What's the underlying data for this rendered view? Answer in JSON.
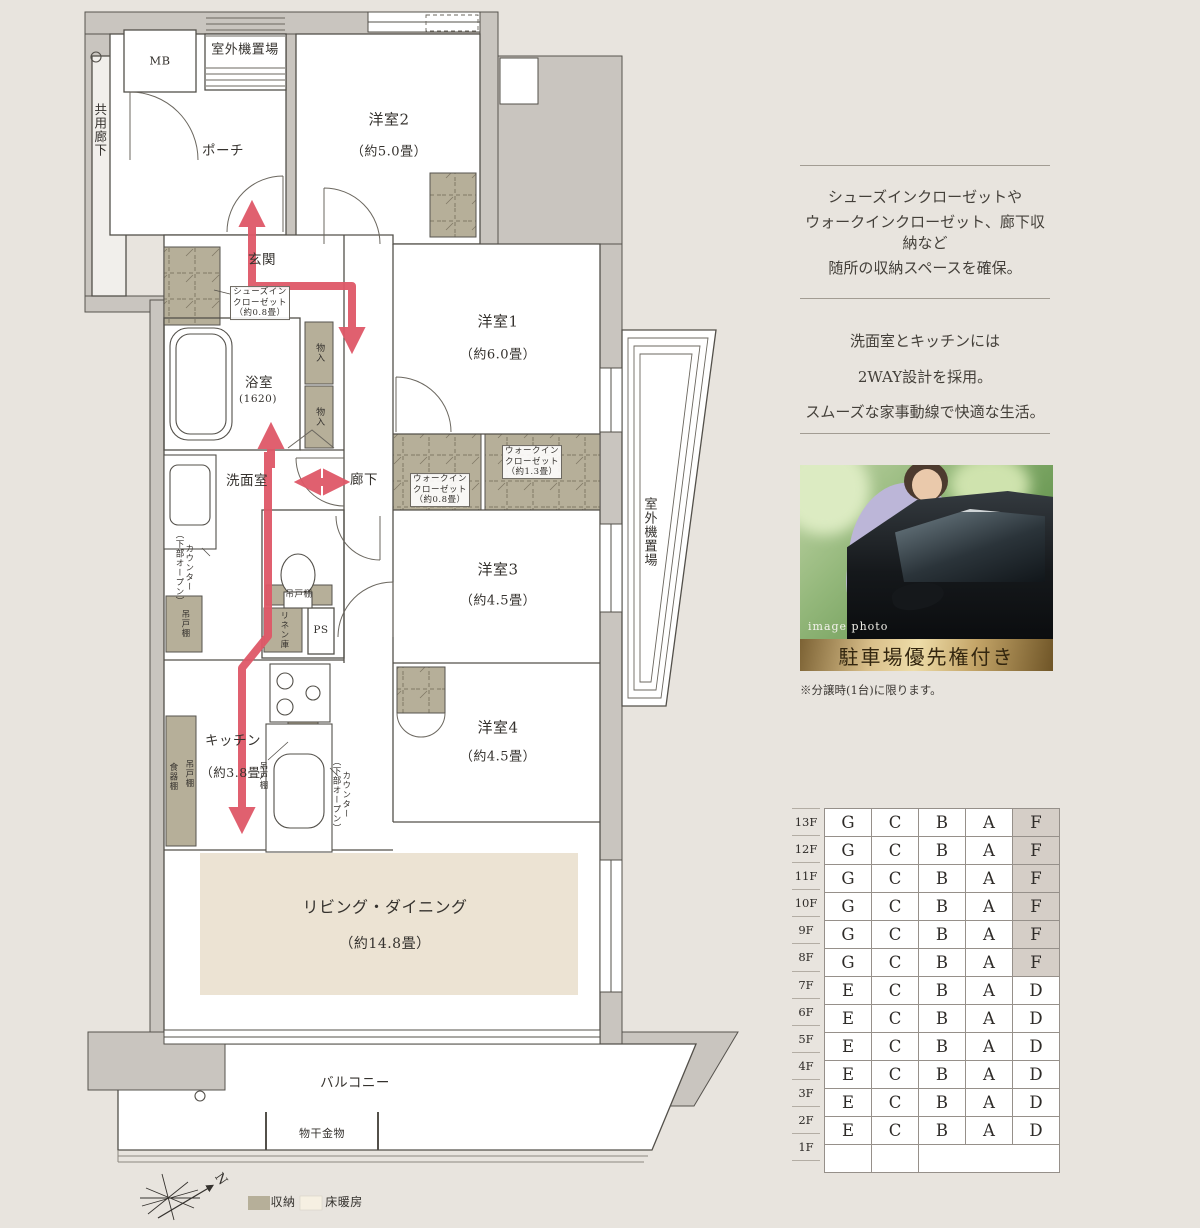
{
  "floor_plan": {
    "labels": {
      "common_corridor": "共用廊下",
      "mb": "MB",
      "outdoor_unit_top": "室外機置場",
      "outdoor_unit_right": "室外機置場",
      "porch": "ポーチ",
      "entrance": "玄関",
      "shoes_in_closet": "シューズイン\nクローゼット\n（約0.8畳）",
      "bath": "浴室",
      "bath_size": "(1620)",
      "storage_small": "物入",
      "washroom": "洗面室",
      "hallway": "廊下",
      "room2": "洋室2",
      "room2_size": "（約5.0畳）",
      "room1": "洋室1",
      "room1_size": "（約6.0畳）",
      "room3": "洋室3",
      "room3_size": "（約4.5畳）",
      "room4": "洋室4",
      "room4_size": "（約4.5畳）",
      "wic_13": "ウォークイン\nクローゼット\n（約1.3畳）",
      "wic_08": "ウォークイン\nクローゼット\n（約0.8畳）",
      "counter_open": "カウンター\n（下部オープン）",
      "hanging_cupboard": "吊戸棚",
      "dish_cupboard": "食器棚",
      "linen": "リネン庫",
      "ps": "PS",
      "kitchen": "キッチン",
      "kitchen_size": "（約3.8畳）",
      "living": "リビング・ダイニング",
      "living_size": "（約14.8畳）",
      "balcony": "バルコニー",
      "drying_fixture": "物干金物",
      "north": "N"
    },
    "legend": {
      "storage": "収納",
      "floor_heating": "床暖房"
    },
    "colors": {
      "storage": "#b6af99",
      "floor_heating": "#ece3d3",
      "arrow": "#df5868",
      "wall": "#c9c5bf",
      "highlight_cell": "#d5cec7",
      "banner_gold": "#c5a669"
    }
  },
  "sidebar": {
    "features": [
      {
        "lines": [
          "シューズインクローゼットや",
          "ウォークインクローゼット、廊下収納など",
          "随所の収納スペースを確保。"
        ]
      },
      {
        "lines": [
          "洗面室とキッチンには",
          "2WAY設計を採用。",
          "スムーズな家事動線で快適な生活。"
        ]
      }
    ],
    "photo": {
      "tag": "image photo",
      "banner": "駐車場優先権付き",
      "note": "※分譲時(1台)に限ります。"
    },
    "table": {
      "floors": [
        "13F",
        "12F",
        "11F",
        "10F",
        "9F",
        "8F",
        "7F",
        "6F",
        "5F",
        "4F",
        "3F",
        "2F",
        "1F"
      ],
      "rows": [
        [
          "G",
          "C",
          "B",
          "A",
          "F"
        ],
        [
          "G",
          "C",
          "B",
          "A",
          "F"
        ],
        [
          "G",
          "C",
          "B",
          "A",
          "F"
        ],
        [
          "G",
          "C",
          "B",
          "A",
          "F"
        ],
        [
          "G",
          "C",
          "B",
          "A",
          "F"
        ],
        [
          "G",
          "C",
          "B",
          "A",
          "F"
        ],
        [
          "E",
          "C",
          "B",
          "A",
          "D"
        ],
        [
          "E",
          "C",
          "B",
          "A",
          "D"
        ],
        [
          "E",
          "C",
          "B",
          "A",
          "D"
        ],
        [
          "E",
          "C",
          "B",
          "A",
          "D"
        ],
        [
          "E",
          "C",
          "B",
          "A",
          "D"
        ],
        [
          "E",
          "C",
          "B",
          "A",
          "D"
        ],
        [
          "",
          "",
          ""
        ]
      ],
      "highlight": {
        "unit": "F",
        "floors": [
          "13F",
          "12F",
          "11F",
          "10F",
          "9F",
          "8F"
        ]
      }
    }
  }
}
